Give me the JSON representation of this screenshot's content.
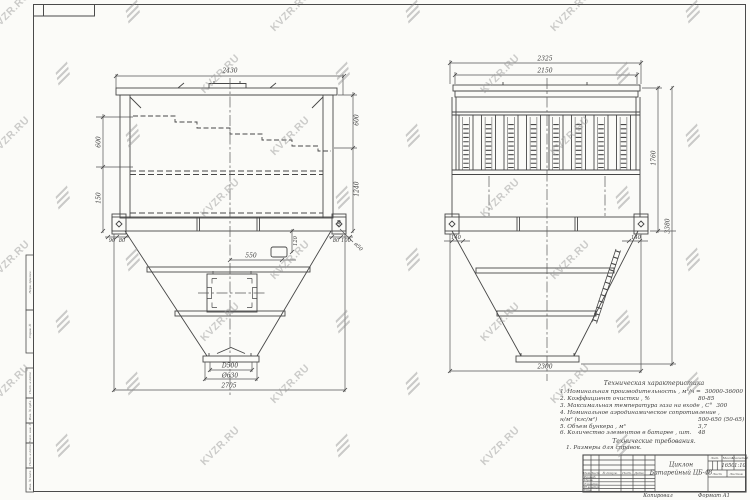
{
  "watermark": {
    "text": "KVZR.RU"
  },
  "views": {
    "front": {
      "dims": {
        "width_top": "2430",
        "left_upper": "600",
        "left_lower": "150",
        "right_upper": "600",
        "right_lower": "1240",
        "under_left_a": "90",
        "under_left_b": "80",
        "under_right_a": "80",
        "under_right_b": "100",
        "plate": "90",
        "leader": "ø50",
        "offset": "550",
        "stub": "120",
        "outlet_square": "D500",
        "outlet_flange": "Ø630",
        "width_bottom": "2705"
      }
    },
    "side": {
      "dims": {
        "width_top": "2325",
        "width_inner": "2150",
        "height_body": "1760",
        "height_total": "3380",
        "left_offset": "140",
        "right_offset": "140",
        "width_bottom": "2300"
      }
    }
  },
  "tech_specs": {
    "title": "Техническая характеристика",
    "items": [
      {
        "label": "1. Номинальная производительность , м³/ч =",
        "value": "30000-36000"
      },
      {
        "label": "2. Коэффициент очистки , %",
        "value": "80-85"
      },
      {
        "label": "3. Максимальная температура газа на входе , С°",
        "value": "300"
      },
      {
        "label": "4. Номинальное аэродинамическое сопротивление ,",
        "value": ""
      },
      {
        "label": "н/м² (кгс/м²)",
        "value": "500-650 (50-65)"
      },
      {
        "label": "5. Объем бункера , м³",
        "value": "3,7"
      },
      {
        "label": "6. Количество элементов в батарее , шт.",
        "value": "48"
      }
    ],
    "requirements_title": "Технические требования.",
    "note": "1. Размеры для справок."
  },
  "title_block": {
    "change_header": [
      "Изм.",
      "Лист",
      "№ докум.",
      "Подп.",
      "Дата"
    ],
    "roles": [
      "Разраб.",
      "Пров.",
      "Т.контр.",
      "Н.контр.",
      "Утв."
    ],
    "product_line1": "Циклон",
    "product_line2": "Батарейный ЦБ-48",
    "stat_headers": [
      "Лит.",
      "Масса",
      "Масштаб"
    ],
    "mass": "1650",
    "scale": "1:10",
    "sheet": "Лист",
    "sheets": "Листов"
  },
  "margin": {
    "labels": [
      "Перв. примен.",
      "Справ. №",
      "Подп. и дата",
      "Инв. № дубл.",
      "Взам. инв. №",
      "Подп. и дата",
      "Инв. № подл."
    ]
  },
  "footer": {
    "left": "Копировал",
    "right": "Формат А1"
  }
}
